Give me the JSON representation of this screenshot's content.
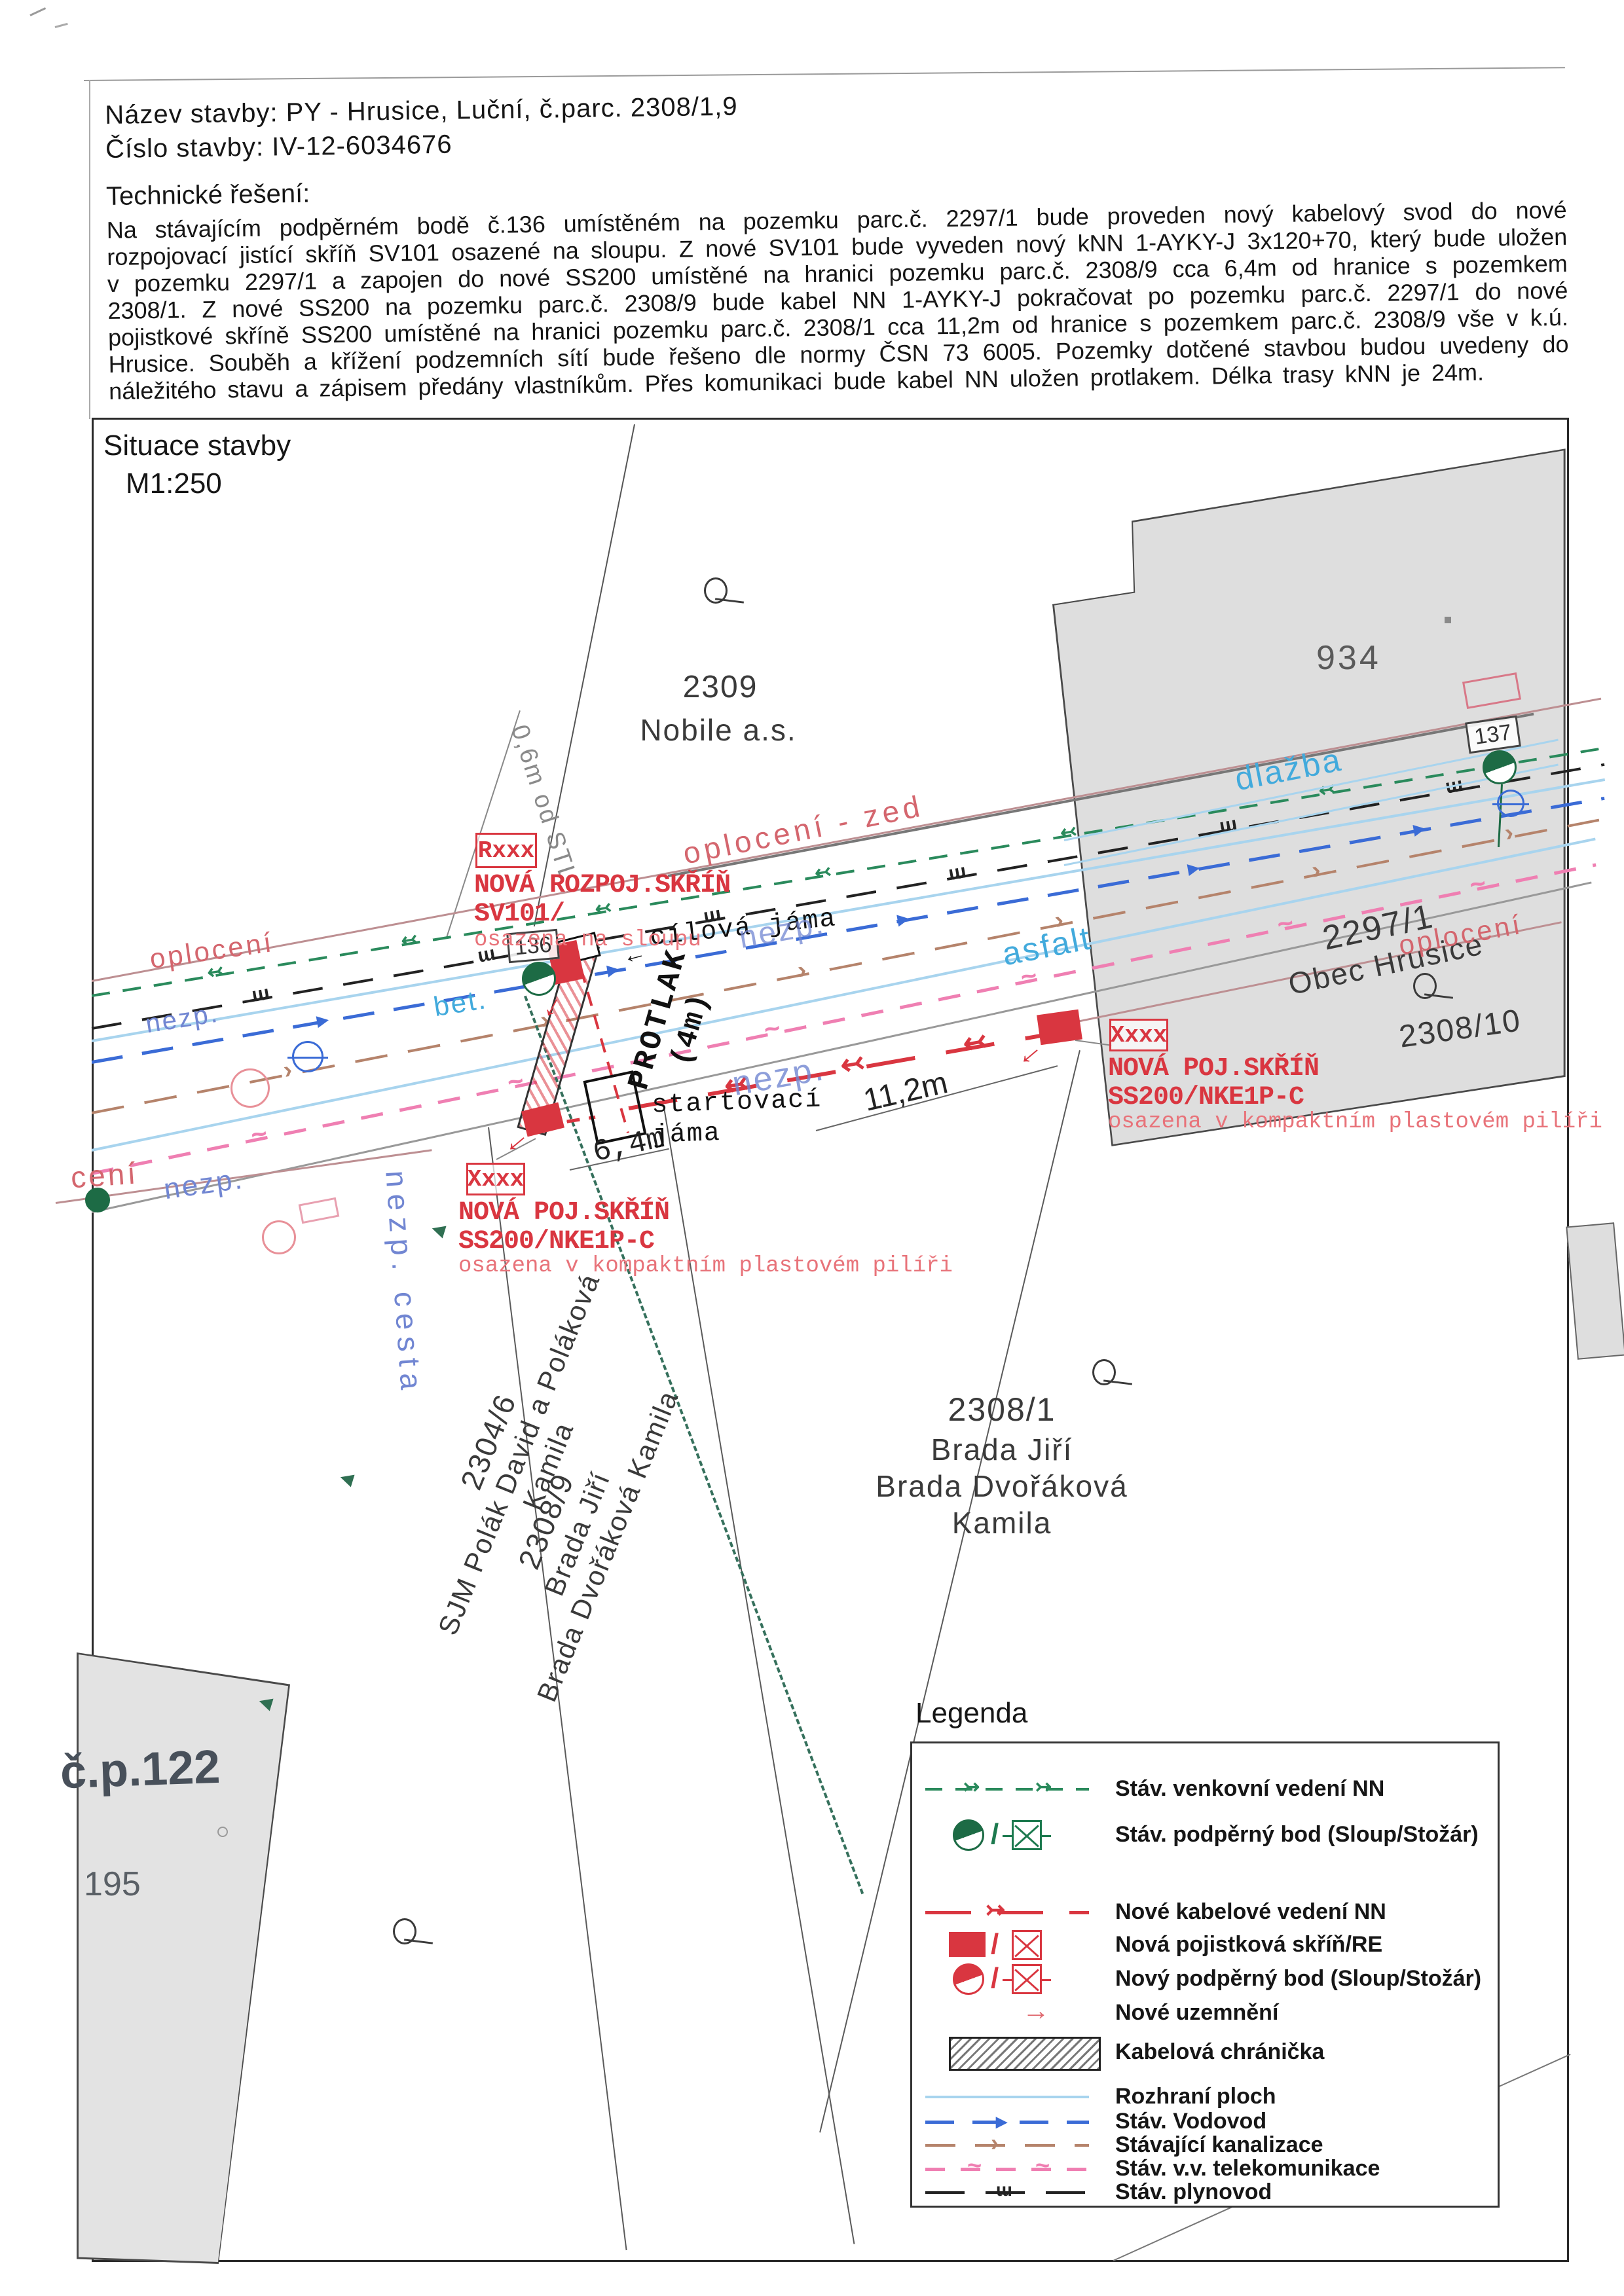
{
  "header": {
    "nazev_label": "Název stavby:",
    "nazev_value": "PY - Hrusice, Luční, č.parc. 2308/1,9",
    "cislo_label": "Číslo stavby:",
    "cislo_value": "IV-12-6034676",
    "tech_title": "Technické řešení:",
    "tech_text": "Na stávajícím podpěrném bodě č.136 umístěném na pozemku parc.č. 2297/1 bude proveden nový kabelový svod do nové rozpojovací jistící skříň SV101 osazené na sloupu. Z nové SV101 bude vyveden nový kNN 1-AYKY-J 3x120+70, který bude uložen v pozemku 2297/1 a zapojen do nové SS200 umístěné na hranici pozemku parc.č. 2308/9 cca 6,4m od hranice s pozemkem 2308/1. Z nové SS200 na pozemku parc.č. 2308/9 bude kabel NN 1-AYKY-J pokračovat po pozemku parc.č. 2297/1 do nové pojistkové skříně SS200 umístěné na hranici pozemku parc.č. 2308/1 cca 11,2m od hranice s pozemkem parc.č. 2308/9 vše v k.ú. Hrusice. Souběh a křížení podzemních sítí bude řešeno dle normy ČSN 73 6005. Pozemky dotčené stavbou budou uvedeny do náležitého stavu a zápisem předány vlastníkům. Přes komunikaci bude kabel NN uložen protlakem. Délka trasy kNN je 24m."
  },
  "map": {
    "title": "Situace stavby",
    "scale": "M1:250",
    "parcels": {
      "p2309": "2309",
      "p2309_owner": "Nobile a.s.",
      "p2297": "2297/1",
      "p2297_owner": "Obec Hrusice",
      "p2308_10": "2308/10",
      "p2308_1": "2308/1",
      "p2308_1_owner": "Brada Jiří\nBrada Dvořáková Kamila",
      "p2304_6": "2304/6",
      "p2304_6_owner": "SJM Polák David a Poláková Kamila",
      "p2308_9": "2308/9",
      "p2308_9_owner": "Brada Jiří\nBrada Dvořáková Kamila",
      "b934": "934",
      "b122": "č.p.122",
      "b195": "195"
    },
    "poles": {
      "n136": "136",
      "n137": "137"
    },
    "surfaces": {
      "oploceni": "oplocení",
      "oploceni_zed": "oplocení - zed",
      "oploceni_cut": "cení",
      "nezp": "nezp.",
      "nezp_cesta": "nezp. cesta",
      "bet": "bet.",
      "asfalt": "asfalt",
      "dlazba": "dlažba"
    },
    "annotations": {
      "sv101": {
        "tag": "Rxxx",
        "name": "NOVÁ ROZPOJ.SKŘÍŇ",
        "code": "SV101/",
        "note": "osazena na sloupu"
      },
      "ss200a": {
        "tag": "Xxxx",
        "name": "NOVÁ POJ.SKŘÍŇ",
        "code": "SS200/NKE1P-C",
        "note": "osazena v kompaktním\nplastovém pilíři"
      },
      "ss200b": {
        "tag": "Xxxx",
        "name": "NOVÁ POJ.SKŘÍŇ",
        "code": "SS200/NKE1P-C",
        "note": "osazena v kompaktním\nplastovém pilíři"
      }
    },
    "measurements": {
      "d64": "6,4m",
      "d112": "11,2m",
      "protlak": "PROTLAK",
      "protlak2": "(4m)",
      "stl": "0,6m od STL",
      "cilova": "cílová jáma",
      "startovaci": "startovací\njáma"
    }
  },
  "legend": {
    "title": "Legenda",
    "items": [
      {
        "label": "Stáv. venkovní vedení NN",
        "type": "green-dashed"
      },
      {
        "label": "Stáv. podpěrný bod (Sloup/Stožár)",
        "type": "green-pole"
      },
      {
        "label": "Nové kabelové vedení NN",
        "type": "red-line"
      },
      {
        "label": "Nová pojistková skříň/RE",
        "type": "red-box"
      },
      {
        "label": "Nový podpěrný bod (Sloup/Stožár)",
        "type": "red-pole"
      },
      {
        "label": "Nové uzemnění",
        "type": "red-arrow"
      },
      {
        "label": "Kabelová chránička",
        "type": "hatch"
      },
      {
        "label": "Rozhraní ploch",
        "type": "cyan-line"
      },
      {
        "label": "Stáv. Vodovod",
        "type": "blue-dashed"
      },
      {
        "label": "Stávající kanalizace",
        "type": "brown-dashed"
      },
      {
        "label": "Stáv. v.v. telekomunikace",
        "type": "pink-dashed"
      },
      {
        "label": "Stáv. plynovod",
        "type": "black-dashed"
      }
    ]
  },
  "icons": {
    "slash": "/",
    "gas_mark": "ɯ",
    "kanal_mark": "›",
    "telekom_mark": "~",
    "vodo_arrow": "▶",
    "nn_arrow": "↢",
    "cable_arrow": "↢",
    "legend_arrow_r": "↣",
    "ground_arrow": "→",
    "left_arrow": "←"
  },
  "colors": {
    "new_red": "#d93640",
    "green": "#1d7a4f",
    "vodovod": "#3a6bd6",
    "rozhrani": "#a8d4ee",
    "kanalizace": "#b5836b",
    "telekom": "#ef7fb2",
    "plynovod": "#222222",
    "building": "#dedede"
  }
}
